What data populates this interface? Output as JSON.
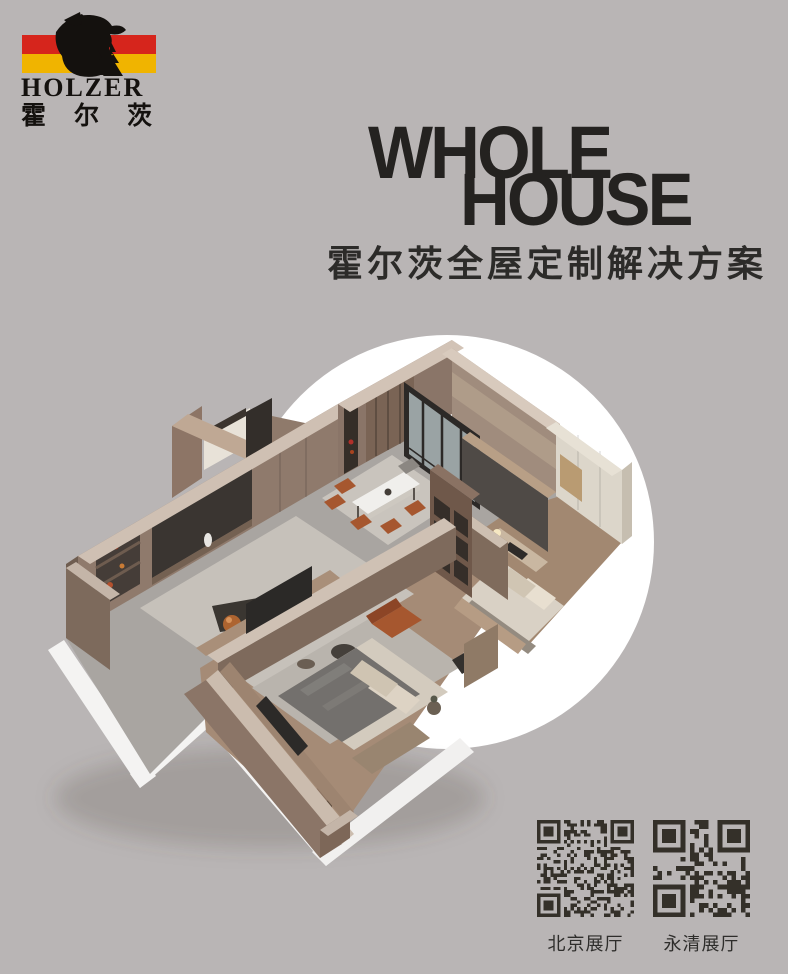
{
  "brand": {
    "latin": "HOLZER",
    "cn": "霍尔茨"
  },
  "title": {
    "line1": "WHOLE",
    "line2": "HOUSE"
  },
  "subtitle": {
    "text": "霍尔茨全屋定制解决方案"
  },
  "hero": {
    "backdrop": "white-circle",
    "subject": "isometric cutaway render of a whole-house custom apartment interior"
  },
  "qr": {
    "items": [
      {
        "label": "北京展厅"
      },
      {
        "label": "永清展厅"
      }
    ]
  },
  "colors": {
    "bg": "#b9b5b5",
    "stripe_red": "#d6251c",
    "stripe_yellow": "#f0b400",
    "ink": "#242220",
    "qr": "#343029",
    "circle": "#ffffff"
  }
}
